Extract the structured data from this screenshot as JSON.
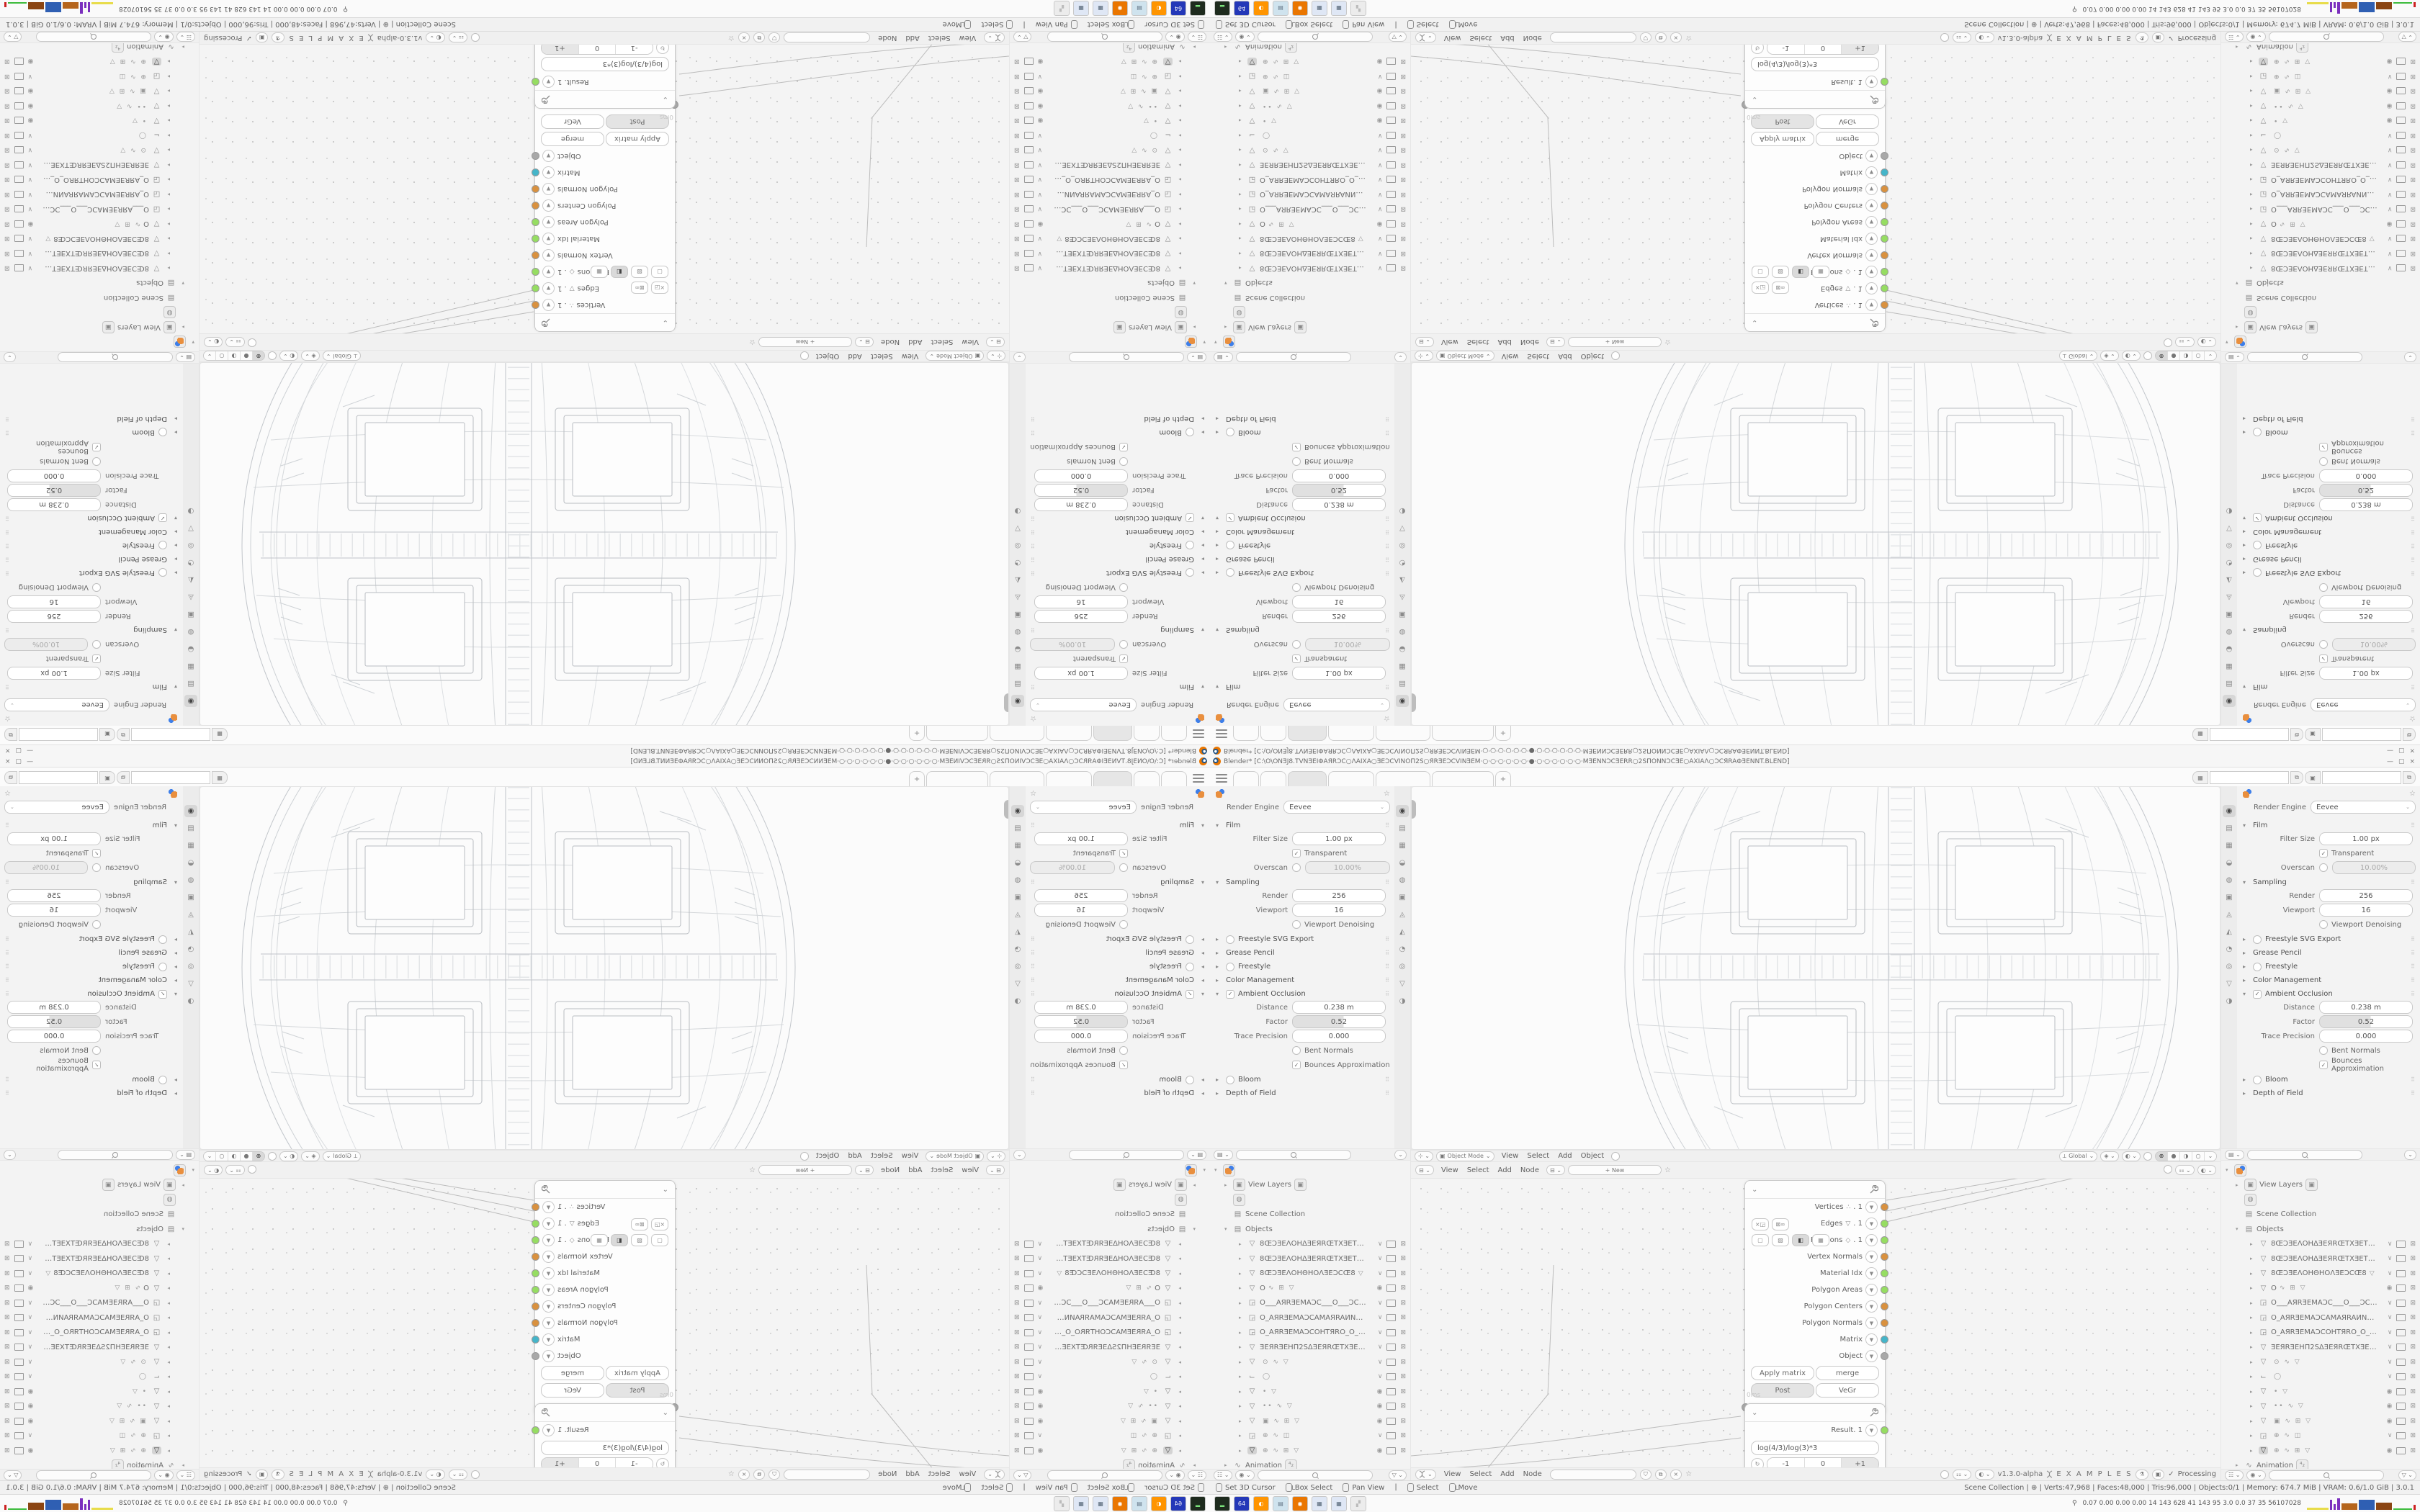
{
  "app": {
    "title": "Blender* [C:\\O\\ONƎJ8.TVNƎEIΦAЯRƆC○ΛAIXA○ƎEƆCVINOΠ2S○ЯRƎEƆCVINƎEM·○·○·○·○·○·○·●·○·○·○·○·○·○·MƎENNƆCƎERR○2SΠONNƆCƎE○AXIAΛ○ƆCЯRAΦƎENNT.BLEND]",
    "minimize": "—",
    "maximize": "▢",
    "close": "×"
  },
  "topbar": {
    "tabs": [
      {
        "w": 34
      },
      {
        "w": 34
      },
      {
        "w": 52,
        "active": true
      },
      {
        "w": 62
      },
      {
        "w": 74
      },
      {
        "w": 84
      }
    ],
    "new_tab_label": "+",
    "scene_icon": "▦",
    "scene_value": "",
    "view_layer_icon": "▣",
    "view_layer_value": "",
    "copy_label": "⧉"
  },
  "properties": {
    "render_engine_label": "Render Engine",
    "render_engine_value": "Eevee",
    "tab_icons": [
      {
        "glyph": "◉",
        "name": "render-properties",
        "active": true
      },
      {
        "glyph": "▤",
        "name": "output-properties"
      },
      {
        "glyph": "▦",
        "name": "view-layer-properties"
      },
      {
        "glyph": "◒",
        "name": "scene-properties"
      },
      {
        "glyph": "◍",
        "name": "world-properties"
      },
      {
        "glyph": "▣",
        "name": "object-properties"
      },
      {
        "glyph": "◬",
        "name": "modifier-properties"
      },
      {
        "glyph": "◭",
        "name": "particle-properties"
      },
      {
        "glyph": "◔",
        "name": "physics-properties"
      },
      {
        "glyph": "◎",
        "name": "constraint-properties"
      },
      {
        "glyph": "▽",
        "name": "data-properties"
      },
      {
        "glyph": "◑",
        "name": "material-properties"
      }
    ],
    "sections": [
      {
        "title": "Film",
        "expanded": true,
        "rows": [
          {
            "kind": "field",
            "label": "Filter Size",
            "value": "1.00 px"
          },
          {
            "kind": "check",
            "label": "Transparent",
            "checked": true
          },
          {
            "kind": "check-field",
            "label": "Overscan",
            "checked": false,
            "value": "10.00%",
            "disabled": true
          }
        ]
      },
      {
        "title": "Sampling",
        "expanded": true,
        "rows": [
          {
            "kind": "field",
            "label": "Render",
            "value": "256"
          },
          {
            "kind": "field",
            "label": "Viewport",
            "value": "16"
          },
          {
            "kind": "check",
            "label": "Viewport Denoising",
            "checked": false
          }
        ]
      },
      {
        "title": "Freestyle SVG Export",
        "expanded": false,
        "checkbox": false
      },
      {
        "title": "Grease Pencil",
        "expanded": false
      },
      {
        "title": "Freestyle",
        "expanded": false,
        "checkbox": false
      },
      {
        "title": "Color Management",
        "expanded": false
      },
      {
        "title": "Ambient Occlusion",
        "expanded": true,
        "checkbox": true,
        "rows": [
          {
            "kind": "field",
            "label": "Distance",
            "value": "0.238 m"
          },
          {
            "kind": "slider",
            "label": "Factor",
            "value": "0.52"
          },
          {
            "kind": "field",
            "label": "Trace Precision",
            "value": "0.000"
          },
          {
            "kind": "check",
            "label": "Bent Normals",
            "checked": false
          },
          {
            "kind": "check",
            "label": "Bounces Approximation",
            "checked": true
          }
        ]
      },
      {
        "title": "Bloom",
        "expanded": false,
        "checkbox": false
      },
      {
        "title": "Depth of Field",
        "expanded": false
      }
    ]
  },
  "viewport_header": {
    "mode_icon": "▣",
    "mode": "Object Mode",
    "menus": [
      "View",
      "Select",
      "Add",
      "Object"
    ],
    "orientation": "Global",
    "shading_modes": [
      "⊕",
      "●",
      "◑",
      "○"
    ],
    "active_shading_index": 0
  },
  "node_editor": {
    "menus": [
      "View",
      "Select",
      "Add",
      "Node"
    ],
    "new_button": "+ New",
    "version": "v1.3.0-alpha",
    "breadcrumb": "E X A M P L E S",
    "processing": "Processing",
    "check": "✓",
    "exec_time": "0ms",
    "mesh_node": {
      "outputs": [
        {
          "label": "Vertices",
          "icon": "∴",
          "suffix": ". 1",
          "socket": "#d9913f"
        },
        {
          "label": "Edges",
          "icon": "▽",
          "suffix": ". 1",
          "socket": "#96dd62"
        },
        {
          "label": "Polygons",
          "icon": "◇",
          "suffix": ". 1",
          "socket": "#96dd62"
        },
        {
          "label": "Vertex Normals",
          "socket": "#d9913f"
        },
        {
          "label": "Material Idx",
          "socket": "#96dd62"
        },
        {
          "label": "Polygon Areas",
          "socket": "#96dd62"
        },
        {
          "label": "Polygon Centers",
          "socket": "#d9913f"
        },
        {
          "label": "Polygon Normals",
          "socket": "#d9913f"
        },
        {
          "label": "Matrix",
          "socket": "#45b5c9"
        },
        {
          "label": "Object",
          "socket": "#a8a8a8"
        }
      ],
      "btn_apply_matrix": "Apply matrix",
      "btn_merge": "merge",
      "btn_post": "Post",
      "btn_vegr": "VeGr",
      "input_label": "Objects. 1"
    },
    "result_node": {
      "output_label": "Result. 1",
      "socket": "#96dd62",
      "expression": "log(4/3)/log(3)*3",
      "stepper": [
        "-1",
        "0",
        "+1"
      ]
    }
  },
  "outliner": {
    "rows": [
      {
        "kind": "root",
        "icon": "an"
      },
      {
        "kind": "item",
        "arrow": "▸",
        "boxicon": "▣",
        "name": "View Layers",
        "badge": "▣"
      },
      {
        "kind": "item",
        "boxicon": "◍",
        "name": ""
      },
      {
        "kind": "item",
        "icon": "▤",
        "name": "Scene Collection"
      },
      {
        "kind": "item",
        "arrow": "▾",
        "icon": "▤",
        "name": "Objects"
      },
      {
        "kind": "obj",
        "icon": "▽",
        "name": "8ŒƆƎEΛOHΔƎEЯRŒTXƎETOTƎEXTŒ8",
        "vis": "∨"
      },
      {
        "kind": "obj",
        "icon": "▽",
        "name": "8ŒƆƎEΛOHΔƎEЯRŒTXƎETΘTƎEXTŒ8",
        "vis": "∨"
      },
      {
        "kind": "obj",
        "icon": "▽",
        "name": "8ŒƆƎEΛOHΘHOΛƎEƆCŒ8",
        "extras": "▽",
        "vis": "∨"
      },
      {
        "kind": "obj",
        "icon": "▽",
        "name": "O",
        "extras": "∿ ⊞ ▽",
        "vis": "◉"
      },
      {
        "kind": "obj",
        "icon": "◲",
        "name": "O___AЯRƎEMAƆC___O___ƆCAMƎI",
        "vis": "∨"
      },
      {
        "kind": "obj",
        "icon": "◲",
        "name": "O_AЯRƎEMAƆCAMAЯRAИNAΠ_O",
        "vis": "∨"
      },
      {
        "kind": "obj",
        "icon": "◲",
        "name": "O_AЯRƎEMAƆCOHTЯRO_O_OЯRTH",
        "vis": "∨"
      },
      {
        "kind": "obj",
        "icon": "▽",
        "name": "ƎEЯRƎEHΠ2SΔƎEЯRŒTXƎETOTƎEXTŒ",
        "vis": "∨"
      },
      {
        "kind": "obj",
        "icon": "▽",
        "name": "",
        "extras": "⊙ ∿ ▽",
        "vis": "∨"
      },
      {
        "kind": "obj",
        "icon": "⌙",
        "name": "",
        "extras": "◯",
        "vis": "∨"
      },
      {
        "kind": "obj",
        "icon": "▽",
        "name": "",
        "extras": "• ▽",
        "vis": "◉"
      },
      {
        "kind": "obj",
        "icon": "▽",
        "name": "",
        "extras": "•• ∿ ▽",
        "vis": "◉"
      },
      {
        "kind": "obj",
        "icon": "▽",
        "name": "",
        "extras": "▣ ∿ ⊞ ▽",
        "vis": "◉"
      },
      {
        "kind": "obj",
        "icon": "◲",
        "name": "",
        "extras": "⊕ ∿ ◫",
        "vis": "∨"
      },
      {
        "kind": "obj",
        "icon": "▽",
        "name": "",
        "extras": "⊕ ∿ ⊞ ▽",
        "vis": "◉",
        "hl": true
      },
      {
        "kind": "item",
        "arrow": "▸",
        "icon": "∿",
        "name": "Animation",
        "badge": "⁴₂"
      }
    ]
  },
  "status_bar": {
    "keymap": [
      {
        "mouse": "l",
        "label": "Set 3D Cursor"
      },
      {
        "mouse": "ld",
        "label": "Box Select"
      },
      {
        "mouse": "m",
        "label": "Pan View"
      },
      {
        "mouse": "l",
        "label": "Select"
      },
      {
        "mouse": "ld",
        "label": "Move"
      }
    ],
    "stats": "Scene Collection | ⊕ | Verts:47,968 | Faces:48,000 | Tris:96,000 | Objects:0/1 | Memory: 674.7 MiB | VRAM: 0.6/1.0 GiB | 3.0.1"
  },
  "taskbar": {
    "apps": [
      {
        "name": "terminal-app",
        "bg": "#1e2b1e",
        "fg": "#7be27b",
        "glyph": "▂"
      },
      {
        "name": "floppy-64-app",
        "bg": "#2438b8",
        "fg": "#ffffff",
        "glyph": "64"
      },
      {
        "name": "firefox",
        "bg": "#ff9500",
        "fg": "#ffffff",
        "glyph": "◐"
      },
      {
        "name": "notes-app",
        "bg": "#cfe3ee",
        "fg": "#678",
        "glyph": "▤"
      },
      {
        "name": "blender-app",
        "bg": "#ea7600",
        "fg": "#fff",
        "glyph": "◉"
      },
      {
        "name": "calculator-app",
        "bg": "#dfe7f5",
        "fg": "#567",
        "glyph": "▦"
      },
      {
        "name": "calculator-2-app",
        "bg": "#dfe7f5",
        "fg": "#567",
        "glyph": "▦"
      },
      {
        "name": "disabled-app",
        "bg": "#ececec",
        "fg": "#bbb",
        "glyph": "▞"
      }
    ],
    "monitor_values": "0.07 0.00 0.00 0.00   14   143   628   41   143   95   3.0   0.0   37   35   56107028",
    "graph_colors": [
      "#e8dc4a",
      "#7b2fbe",
      "#b5651d",
      "#2f5fb3",
      "#8b4513",
      "#3dbb3d",
      "#cc2222"
    ]
  },
  "colors": {
    "socket_orange": "#d9913f",
    "socket_green": "#96dd62",
    "socket_teal": "#45b5c9",
    "socket_grey": "#a8a8a8",
    "accent_orange": "#ea7600",
    "wire_grey": "#b9b9b9"
  }
}
